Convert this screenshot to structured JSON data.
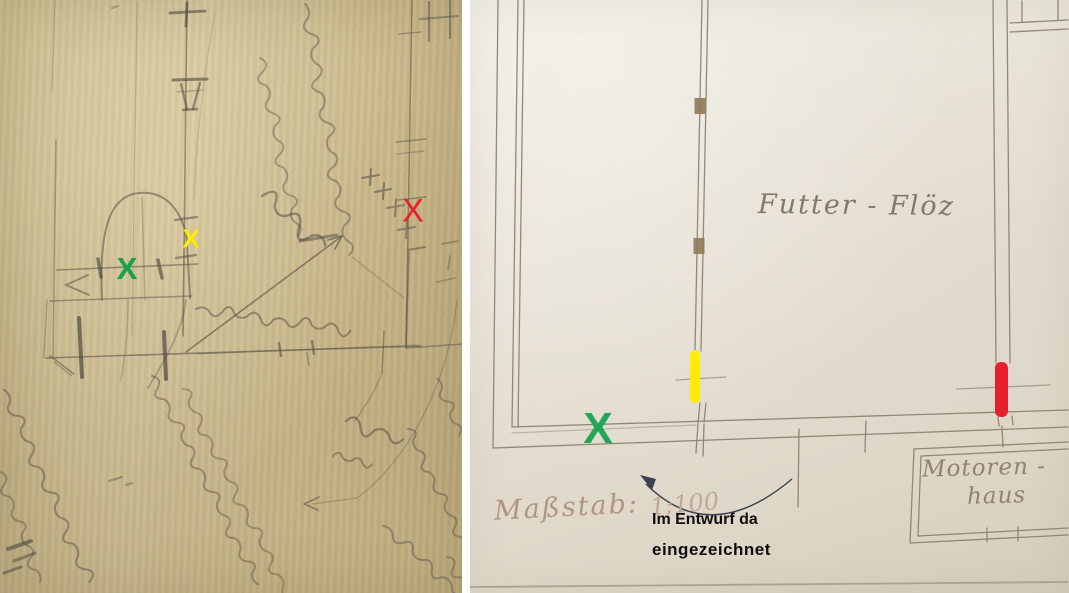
{
  "left_panel": {
    "marks": {
      "green_x": {
        "glyph": "X",
        "color": "#17a349"
      },
      "yellow_x": {
        "glyph": "X",
        "color": "#ffec00"
      },
      "red_x": {
        "glyph": "X",
        "color": "#ee1c25"
      }
    }
  },
  "right_panel": {
    "room_label": "Futter - Flöz",
    "scale_label": "Maßstab:",
    "scale_value": "1:100",
    "motor_house_label_line1": "Motoren -",
    "motor_house_label_line2": "haus",
    "green_x": {
      "glyph": "X",
      "color": "#1fa857"
    },
    "highlights": {
      "yellow_bar": {
        "color": "#ffec00"
      },
      "red_bar": {
        "color": "#e8202c"
      }
    }
  },
  "annotation": {
    "line1": "Im Entwurf da",
    "line2": "eingezeichnet"
  }
}
